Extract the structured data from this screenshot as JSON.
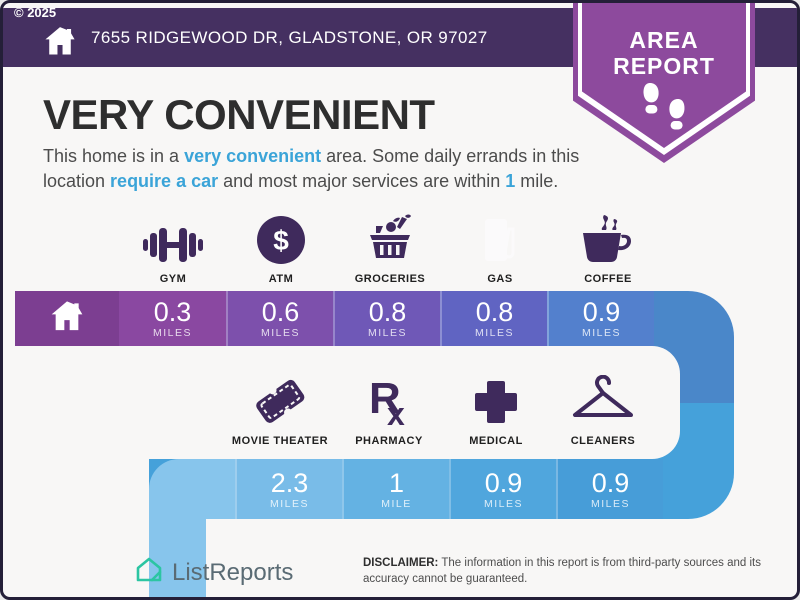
{
  "header": {
    "copyright": "© 2025",
    "address": "7655 RIDGEWOOD DR, GLADSTONE, OR 97027"
  },
  "badge": {
    "line1": "AREA",
    "line2": "REPORT",
    "icon": "footprints-icon"
  },
  "main": {
    "title": "VERY CONVENIENT",
    "description": {
      "pre": "This home is in a ",
      "hl1": "very convenient",
      "mid1": " area. Some daily errands in this location ",
      "hl2": "require a car",
      "mid2": " and most major services are within ",
      "hl3": "1",
      "post": " mile."
    }
  },
  "amenities_row1": [
    {
      "label": "GYM",
      "icon": "dumbbell-icon"
    },
    {
      "label": "ATM",
      "icon": "dollar-circle-icon"
    },
    {
      "label": "GROCERIES",
      "icon": "grocery-basket-icon"
    },
    {
      "label": "GAS",
      "icon": "gas-pump-icon"
    },
    {
      "label": "COFFEE",
      "icon": "coffee-cup-icon"
    }
  ],
  "bar1": {
    "home_icon": "home-icon",
    "home_color": "#7c3e91",
    "cells": [
      {
        "value": "0.3",
        "unit": "MILES",
        "color": "#8a48a1"
      },
      {
        "value": "0.6",
        "unit": "MILES",
        "color": "#7d50ac"
      },
      {
        "value": "0.8",
        "unit": "MILES",
        "color": "#6f58b7"
      },
      {
        "value": "0.8",
        "unit": "MILES",
        "color": "#6064c2"
      },
      {
        "value": "0.9",
        "unit": "MILES",
        "color": "#5380cd"
      }
    ]
  },
  "amenities_row2": [
    {
      "label": "MOVIE THEATER",
      "icon": "movie-ticket-icon"
    },
    {
      "label": "PHARMACY",
      "icon": "rx-icon"
    },
    {
      "label": "MEDICAL",
      "icon": "medical-cross-icon"
    },
    {
      "label": "CLEANERS",
      "icon": "hanger-icon"
    }
  ],
  "bar2": {
    "cap_color": "#87c5ec",
    "cells": [
      {
        "value": "2.3",
        "unit": "MILES",
        "color": "#79bce8"
      },
      {
        "value": "1",
        "unit": "MILE",
        "color": "#64b2e3"
      },
      {
        "value": "0.9",
        "unit": "MILES",
        "color": "#50a6dd"
      },
      {
        "value": "0.9",
        "unit": "MILES",
        "color": "#479dd8"
      }
    ]
  },
  "footer": {
    "brand": "ListReports",
    "disclaimer_label": "DISCLAIMER:",
    "disclaimer_text": " The information in this report is from third-party sources and its accuracy cannot be guaranteed."
  },
  "colors": {
    "header_bg": "#453061",
    "badge_purple": "#8d4a9d",
    "accent_blue": "#3ba4d8",
    "icon_purple": "#3f2a5c",
    "ribbon_top": "#4a87c9",
    "ribbon_bottom": "#45a1da",
    "band_blue": "#87c5ec",
    "logo_teal": "#2cc5a2",
    "page_bg": "#f8f7f6",
    "frame": "#241f38"
  }
}
